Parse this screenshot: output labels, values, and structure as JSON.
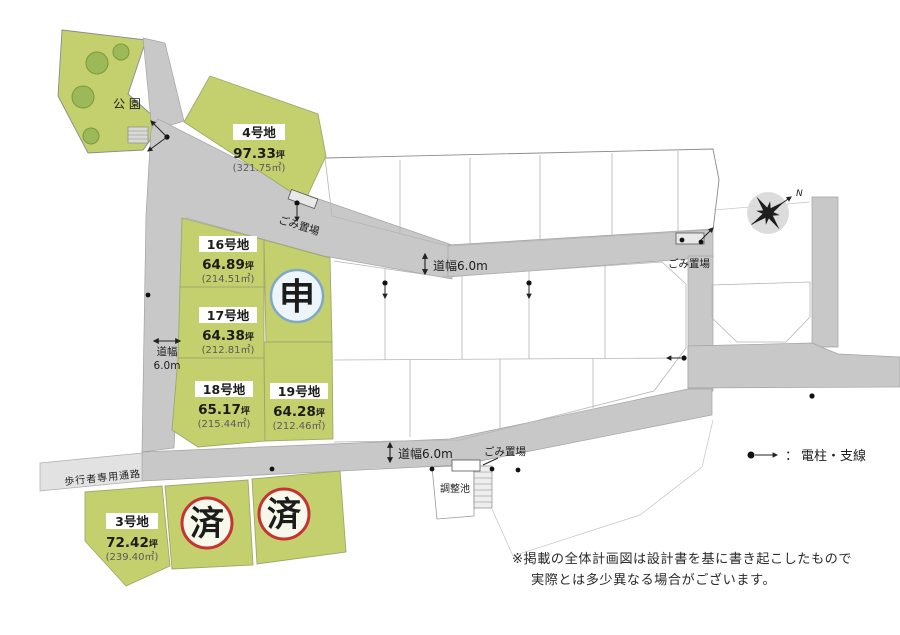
{
  "map": {
    "park_label": "公 園",
    "lots": [
      {
        "name": "4号地",
        "tsubo_value": "97.33",
        "tsubo_unit": "坪",
        "sqm": "(321.75㎡)"
      },
      {
        "name": "16号地",
        "tsubo_value": "64.89",
        "tsubo_unit": "坪",
        "sqm": "(214.51㎡)"
      },
      {
        "name": "17号地",
        "tsubo_value": "64.38",
        "tsubo_unit": "坪",
        "sqm": "(212.81㎡)"
      },
      {
        "name": "18号地",
        "tsubo_value": "65.17",
        "tsubo_unit": "坪",
        "sqm": "(215.44㎡)"
      },
      {
        "name": "19号地",
        "tsubo_value": "64.28",
        "tsubo_unit": "坪",
        "sqm": "(212.46㎡)"
      },
      {
        "name": "3号地",
        "tsubo_value": "72.42",
        "tsubo_unit": "坪",
        "sqm": "(239.40㎡)"
      }
    ],
    "status": {
      "applied": "申",
      "sold": "済"
    },
    "labels": {
      "road_width": "道幅6.0m",
      "road_width_line1": "道幅",
      "road_width_line2": "6.0m",
      "garbage": "ごみ置場",
      "pond": "調整池",
      "pedestrian_path": "歩行者専用通路",
      "compass_north": "N"
    },
    "legend": {
      "separator": "：",
      "label": "電柱・支線"
    },
    "note": {
      "line1": "※掲載の全体計画図は設計書を基に書き起こしたもので",
      "line2": "実際とは多少異なる場合がございます。"
    },
    "colors": {
      "lot_green": "#c4cf6e",
      "road_gray": "#c8c8c8",
      "path_gray": "#e2e2e2",
      "steps_gray": "#d9d9d9",
      "tree_green": "#9cb959",
      "tree_edge": "#79993f",
      "applied_blue": "#1558b8",
      "applied_ring": "#7fa8c9",
      "applied_fill": "#edf5fb",
      "sold_red": "#c63333",
      "green_edge": "#a0a86b"
    }
  }
}
